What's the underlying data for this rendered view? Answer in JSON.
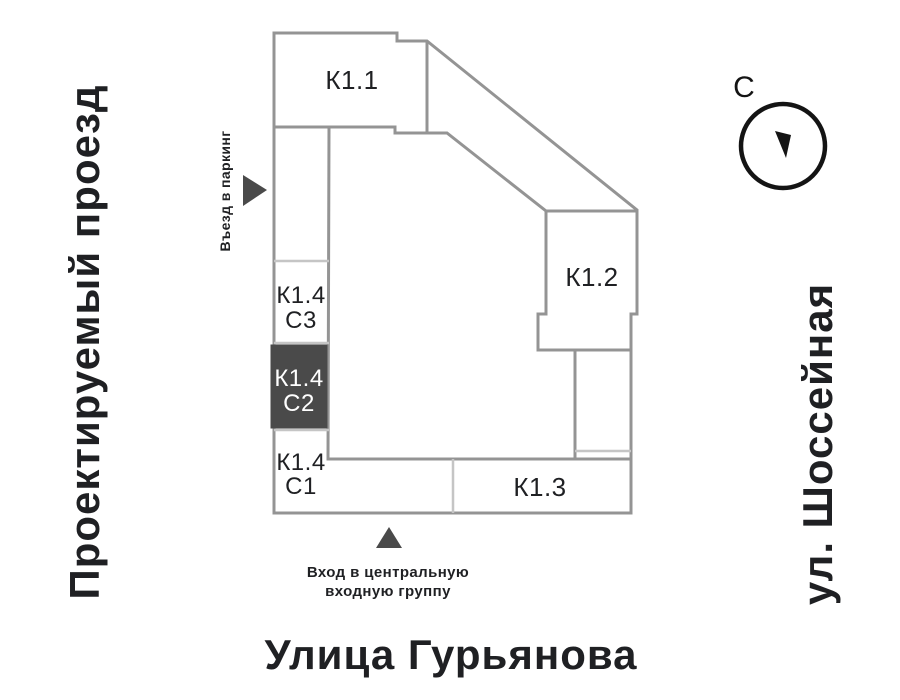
{
  "colors": {
    "outline": "#949494",
    "divider": "#c5c5c5",
    "selected": "#4a4a4a",
    "selected_text": "#ffffff",
    "ink": "#1f2023",
    "compass": "#141414"
  },
  "streets": {
    "left": "Проектируемый проезд",
    "right": "ул. Шоссейная",
    "bottom": "Улица Гурьянова"
  },
  "compass": {
    "north_label": "С"
  },
  "buildings": {
    "k11": {
      "label": "К1.1"
    },
    "k12": {
      "label": "К1.2"
    },
    "k13": {
      "label": "К1.3"
    },
    "k14c3": {
      "line1": "К1.4",
      "line2": "С3"
    },
    "k14c2": {
      "line1": "К1.4",
      "line2": "С2",
      "selected": true
    },
    "k14c1": {
      "line1": "К1.4",
      "line2": "С1"
    }
  },
  "annotations": {
    "parking": "Въезд в паркинг",
    "entrance_line1": "Вход в центральную",
    "entrance_line2": "входную группу"
  }
}
